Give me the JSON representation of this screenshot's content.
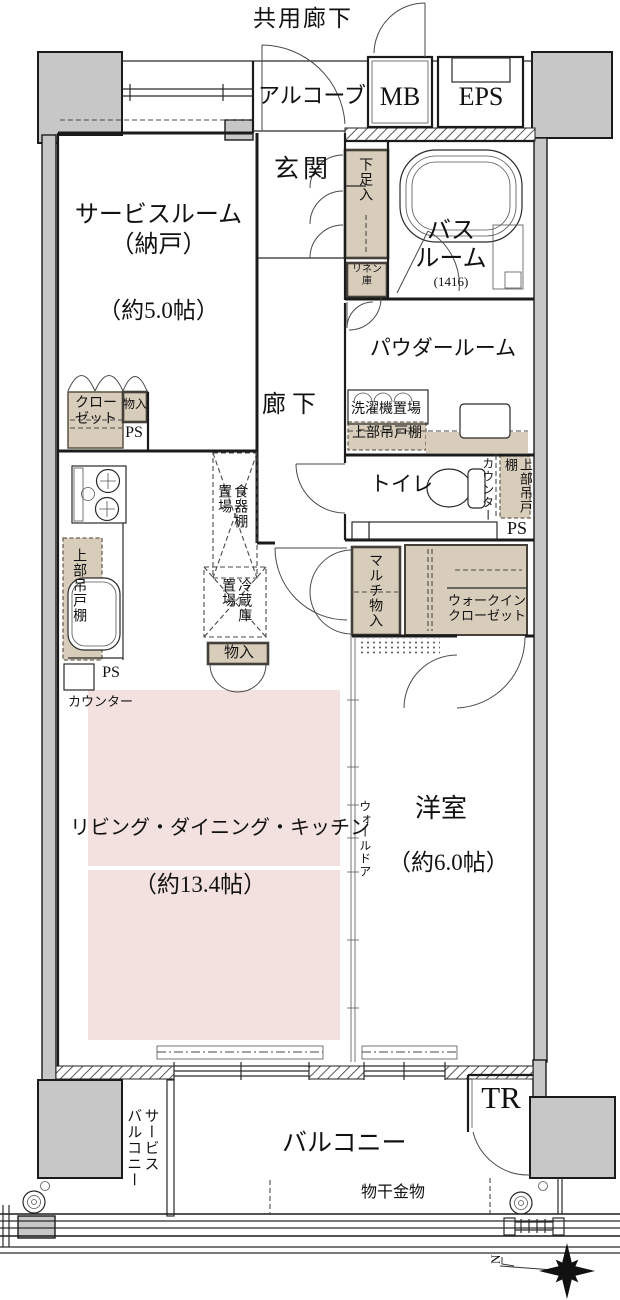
{
  "header": {
    "shared_corridor": "共用廊下"
  },
  "exterior": {
    "alcove": "アルコーブ",
    "mb": "MB",
    "eps": "EPS",
    "balcony": "バルコニー",
    "service_balcony_line1": "サービス",
    "service_balcony_line2": "バルコニー",
    "trunk_room": "TR",
    "laundry_hardware": "物干金物",
    "north_mark": "N"
  },
  "rooms": {
    "service_room": {
      "name": "サービスルーム",
      "alt": "（納戸）",
      "size": "（約5.0帖）"
    },
    "entrance": "玄関",
    "bathroom": {
      "line1": "バス",
      "line2": "ルーム",
      "size": "(1416)"
    },
    "powder_room": "パウダールーム",
    "toilet": "トイレ",
    "corridor": "廊下",
    "ldk": {
      "name": "リビング・ダイニング・キッチン",
      "size": "（約13.4帖）"
    },
    "western_room": {
      "name": "洋室",
      "size": "（約6.0帖）"
    }
  },
  "storage": {
    "shoe_cabinet": "下足入",
    "linen": {
      "line1": "リネン",
      "line2": "庫"
    },
    "washer_space": "洗濯機置場",
    "upper_cabinet": "上部吊戸棚",
    "counter": "カウンター",
    "closet": {
      "line1": "クロー",
      "line2": "ゼット"
    },
    "storage_small": "物入",
    "dish_shelf": {
      "line1": "食器棚",
      "line2": "置場"
    },
    "fridge_space": {
      "line1": "冷蔵庫",
      "line2": "置場"
    },
    "multi_storage": "マルチ物入",
    "walk_in_closet": {
      "line1": "ウォークイン",
      "line2": "クローゼット"
    },
    "wall_door": "ウォールドア",
    "pipe_space": "PS"
  },
  "colors": {
    "floor_pink": "#f2e1de",
    "storage_beige": "#d8cdbb",
    "pillar_gray": "#c7c7c7",
    "line": "#1b1b1b"
  }
}
